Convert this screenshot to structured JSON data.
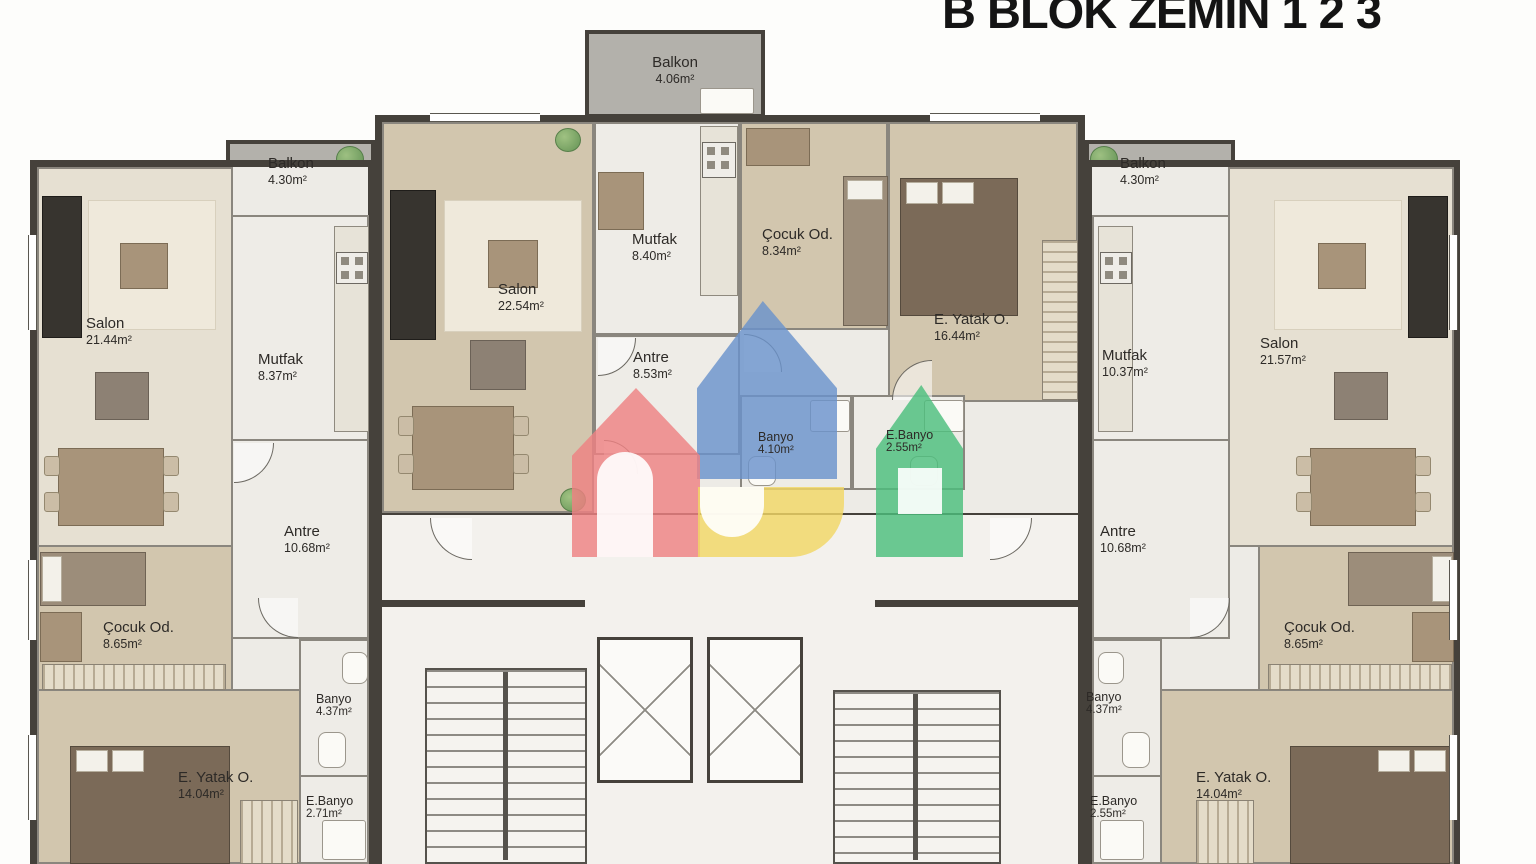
{
  "title": "B BLOK ZEMİN 1 2 3",
  "units": {
    "left": {
      "balkon": {
        "name": "Balkon",
        "area": "4.30m²"
      },
      "salon": {
        "name": "Salon",
        "area": "21.44m²"
      },
      "mutfak": {
        "name": "Mutfak",
        "area": "8.37m²"
      },
      "antre": {
        "name": "Antre",
        "area": "10.68m²"
      },
      "cocuk": {
        "name": "Çocuk Od.",
        "area": "8.65m²"
      },
      "banyo": {
        "name": "Banyo",
        "area": "4.37m²"
      },
      "ebanyo": {
        "name": "E.Banyo",
        "area": "2.71m²"
      },
      "yatak": {
        "name": "E. Yatak O.",
        "area": "14.04m²"
      }
    },
    "center": {
      "balkon": {
        "name": "Balkon",
        "area": "4.06m²"
      },
      "salon": {
        "name": "Salon",
        "area": "22.54m²"
      },
      "mutfak": {
        "name": "Mutfak",
        "area": "8.40m²"
      },
      "antre": {
        "name": "Antre",
        "area": "8.53m²"
      },
      "cocuk": {
        "name": "Çocuk Od.",
        "area": "8.34m²"
      },
      "banyo": {
        "name": "Banyo",
        "area": "4.10m²"
      },
      "ebanyo": {
        "name": "E.Banyo",
        "area": "2.55m²"
      },
      "yatak": {
        "name": "E. Yatak O.",
        "area": "16.44m²"
      }
    },
    "right": {
      "balkon": {
        "name": "Balkon",
        "area": "4.30m²"
      },
      "mutfak": {
        "name": "Mutfak",
        "area": "10.37m²"
      },
      "salon": {
        "name": "Salon",
        "area": "21.57m²"
      },
      "antre": {
        "name": "Antre",
        "area": "10.68m²"
      },
      "cocuk": {
        "name": "Çocuk Od.",
        "area": "8.65m²"
      },
      "banyo": {
        "name": "Banyo",
        "area": "4.37m²"
      },
      "ebanyo": {
        "name": "E.Banyo",
        "area": "2.55m²"
      },
      "yatak": {
        "name": "E. Yatak O.",
        "area": "14.04m²"
      }
    }
  },
  "colors": {
    "watermark_blue": "#6a92cc",
    "watermark_red": "#ee8182",
    "watermark_yellow": "#f2d765",
    "watermark_green": "#4cbe7c",
    "wall": "#45413b",
    "floor_wood": "#d2c6ae",
    "floor_tile": "#eeece7",
    "balcony_gray": "#b3b1ab"
  }
}
